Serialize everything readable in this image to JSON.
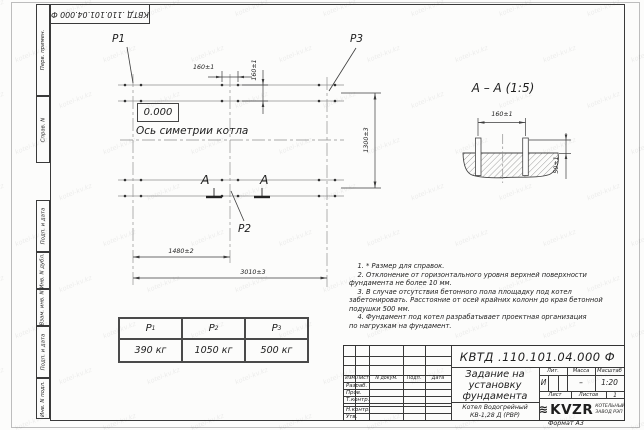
{
  "corner_stamp": "КВТД .110.101.04.000 Ф",
  "margin_labels": [
    "Перв. примен.",
    "Справ. N",
    "Подп. и дата",
    "Инв. N дубл.",
    "Взам. инв. N",
    "Подп. и дата",
    "Инв. N подл."
  ],
  "plan": {
    "load_labels": {
      "p1": "P1",
      "p2": "P2",
      "p3": "P3"
    },
    "elevation": "0.000",
    "axis_label": "Ось симетрии котла",
    "section_letter": "A",
    "dims": {
      "bolt_h": "160±1",
      "bolt_v": "160±1",
      "width": "1300±3",
      "mid": "1480±2",
      "total": "3010±3"
    }
  },
  "section_view": {
    "title": "А – А (1:5)",
    "dim_spacing": "160±1",
    "dim_height": "50±1"
  },
  "loads_table": {
    "columns": [
      {
        "base": "P",
        "sub": "1",
        "value": "390 кг"
      },
      {
        "base": "P",
        "sub": "2",
        "value": "1050 кг"
      },
      {
        "base": "P",
        "sub": "3",
        "value": "500 кг"
      }
    ]
  },
  "notes": {
    "lines": [
      "    1. * Размер для справок.",
      "    2. Отклонение от горизонтального уровня верхней поверхности",
      "фундамента не более 10 мм.",
      "    3. В случае отсутствия бетонного пола площадку под котел",
      "забетонировать. Расстояние от осей крайних колонн до края бетонной",
      "подушки 500 мм.",
      "    4. Фундамент под котел разрабатывает проектная организация",
      "по нагрузкам на фундамент."
    ]
  },
  "titleblock": {
    "designation": "КВТД .110.101.04.000 Ф",
    "title_lines": [
      "Задание на",
      "установку",
      "фундамента"
    ],
    "product_lines": [
      "Котел Водогрейный",
      "КВ-1,28 Д (РВР)"
    ],
    "header_cols": {
      "izm_list": "Изм.Лист",
      "doc": "N докум.",
      "podp": "Подп.",
      "data": "Дата"
    },
    "rows": {
      "razrab": "Разраб.",
      "prov": "Пров.",
      "tkontr": "Т.контр.",
      "nkontr": "Н.контр.",
      "utv": "Утв."
    },
    "lit_label": "Лит.",
    "mass_label": "Масса",
    "scale_label": "Масштаб",
    "lit_value": "И",
    "mass_value": "–",
    "scale_value": "1:20",
    "sheet_label": "Лист",
    "sheets_label": "Листов",
    "sheets_value": "1",
    "company": {
      "logo": "KVZR",
      "tagline1": "КОТЕЛЬНЫЙ",
      "tagline2": "ЗАВОД РЭП"
    },
    "format": "Формат А3"
  },
  "watermark": {
    "text": "kotel-kv.kz"
  }
}
